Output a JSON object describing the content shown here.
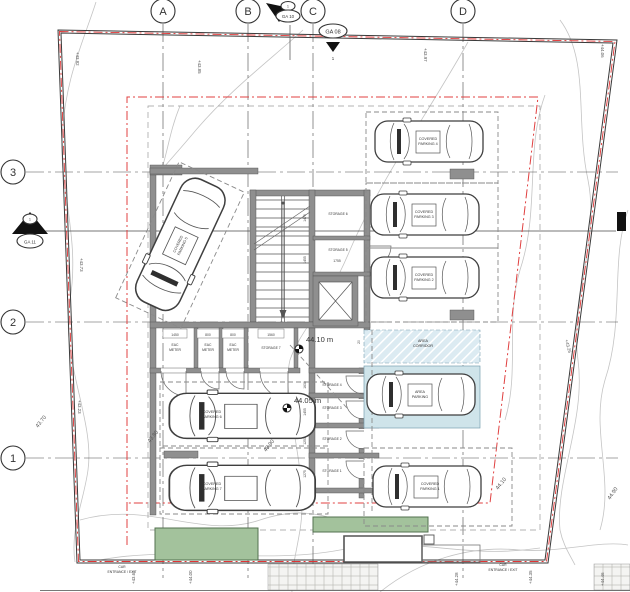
{
  "grid": {
    "columns": [
      "A",
      "B",
      "C",
      "D"
    ],
    "rows": [
      "3",
      "2",
      "1"
    ]
  },
  "ga_markers": {
    "ga10": {
      "id": "GA 10",
      "num": "1"
    },
    "ga08": {
      "id": "GA 08",
      "num": "1"
    },
    "ga11": {
      "id": "GA 11",
      "num": "1"
    }
  },
  "parking_labels": {
    "p4": {
      "l1": "COVERED",
      "l2": "PARKING 4"
    },
    "p3": {
      "l1": "COVERED",
      "l2": "PARKING 3"
    },
    "p2": {
      "l1": "COVERED",
      "l2": "PARKING 2"
    },
    "p1": {
      "l1": "COVERED",
      "l2": "PARKING 1"
    },
    "p5": {
      "l1": "COVERED",
      "l2": "PARKING 5"
    },
    "p6": {
      "l1": "COVERED",
      "l2": "PARKING 6"
    },
    "p7": {
      "l1": "COVERED",
      "l2": "PARKING 7"
    },
    "area_parking": {
      "l1": "AREA",
      "l2": "PARKING"
    },
    "area_corridor": {
      "l1": "AREA",
      "l2": "CORRIDOR"
    }
  },
  "rooms": {
    "storage6": "STORAGE 6",
    "storage5": "STORAGE 5",
    "storage4": "STORAGE 4",
    "storage3": "STORAGE 3",
    "storage2": "STORAGE 2",
    "storage1": "STORAGE 1",
    "storage7": "STORAGE 7",
    "eac": {
      "l1": "EAC",
      "l2": "METER"
    }
  },
  "levels": {
    "upper": "44.10 m",
    "lower": "44.05 m"
  },
  "entrances": {
    "left": {
      "l1": "CAR",
      "l2": "ENTRANCE / EXIT"
    },
    "right": {
      "l1": "CAR",
      "l2": "ENTRANCE / EXIT"
    }
  },
  "spot_elevations": {
    "e1": "+43.82",
    "e2": "+43.85",
    "e3": "+43.97",
    "e4": "+44.06",
    "e5": "+43.73",
    "e6": "+43.23",
    "e7": "+43.26",
    "e8": "+43.62",
    "e9": "+44.00",
    "e10": "+44.28",
    "e11": "+44.35",
    "e12": "+44.46"
  },
  "contour_elevations": {
    "c1": "43.70",
    "c2": "43.80",
    "c3": "43.90",
    "c4": "44.10",
    "c5": "44.90"
  },
  "dims": {
    "meter_rooms": [
      "1450",
      "800",
      "800",
      "1560"
    ],
    "storage_top": [
      "1475",
      "1455",
      "1755"
    ],
    "storage_side": [
      "1630",
      "1455",
      "1250",
      "1275"
    ],
    "misc": [
      "20",
      "35"
    ]
  },
  "colors": {
    "boundary_red": "#e03535",
    "parking_fill": "#cfe4ea",
    "corridor_fill": "#dcebf2",
    "planter_fill": "#a3c29c",
    "wall_gray": "#8f8f8f"
  }
}
